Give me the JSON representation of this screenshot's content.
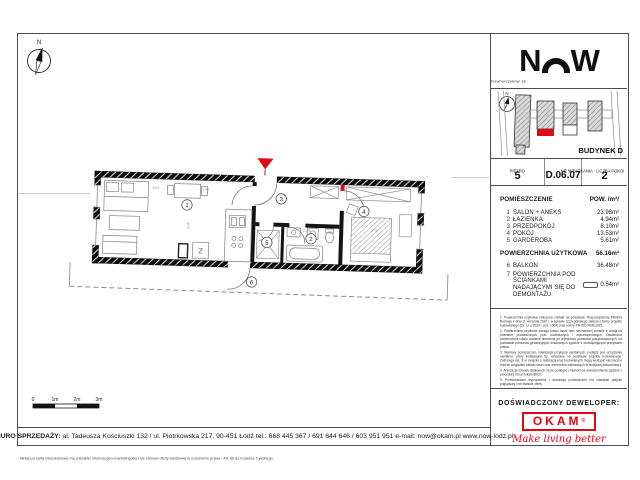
{
  "compass": {
    "label": "N"
  },
  "scalebar": {
    "labels": [
      "0",
      "1m",
      "2m",
      "3m"
    ]
  },
  "plan": {
    "kitchen_label": "Z",
    "dims": [
      "6.03",
      "5.88",
      "3.60",
      "2.38",
      "3.78"
    ],
    "room_markers": [
      "1",
      "2",
      "3",
      "4",
      "5",
      "6"
    ]
  },
  "sidebar": {
    "logo": {
      "left": "N",
      "right": "W",
      "subtitle": "Dowborczyków 18"
    },
    "sitemap": {
      "compass_label": "N",
      "building_label": "BUDYNEK D"
    },
    "unit": {
      "fields": [
        {
          "label": "PIĘTRO",
          "value": "5"
        },
        {
          "label": "NR MIESZKANIA",
          "value": "D.06.07"
        },
        {
          "label": "LICZBA POKOI",
          "value": "2"
        }
      ]
    },
    "rooms": {
      "header_name": "POMIESZCZENIE",
      "header_area": "POW. /m²/",
      "items": [
        {
          "no": "1",
          "name": "SALON + ANEKS",
          "area": "23.98m²"
        },
        {
          "no": "2",
          "name": "ŁAZIENKA",
          "area": "4.94m²"
        },
        {
          "no": "3",
          "name": "PRZEDPOKÓJ",
          "area": "8.10m²"
        },
        {
          "no": "4",
          "name": "POKÓJ",
          "area": "13.53m²"
        },
        {
          "no": "5",
          "name": "GARDEROBA",
          "area": "5.61m²"
        }
      ],
      "total_label": "POWIERZCHNIA UŻYTKOWA",
      "total_area": "56.16m²",
      "extra_items": [
        {
          "no": "6",
          "name": "BALKON",
          "area": "36.48m²"
        },
        {
          "no": "7",
          "name": "POWIERZCHNIA POD ŚCIANKAMI NADAJĄCYMI SIĘ DO DEMONTAŻU",
          "area": "0.54m²"
        }
      ]
    },
    "legal": {
      "paragraphs": [
        "1. Powierzchnia użytkowa obliczona została na podstawie Rozporządzenia Ministra Rozwoju z dnia 11 września 2020 r. w sprawie szczegółowego zakresu i formy projektu budowlanego (Dz. U. z 2020 r. poz. 1609) oraz normy PN-ISO 9836:2015.",
        "2. Powierzchnia użytkowa danego lokalu może ulec nieznacznej zmianie z uwagi na charakter prowadzonych prac budowlanych i wykończeniowych. Ostateczna powierzchnia lokalu zostanie określona po wykonaniu pomiarów powykonawczych, na podstawie pomiarów geodezyjnych dokonanych zgodnie z obowiązującymi przepisami prawa.",
        "3. Wymiary pomieszczeń, lokalizacja przyłączy sanitarnych, podejść pod urządzenia sanitarne, piony instalacyjne itp. wskazane na podstawie projektu budowlanego. Zastrzega się, iż w związku z realizacją prac budowlanych mogą wystąpić nieznaczne różnice względem układu ścian oraz elementów wskazanych w niniejszej dokumentacji.",
        "4. Aranżacja ścianek działowych może podlegać zmianom na wniosek klienta zgodnie z procedurą zmian lokatorskich.",
        "5. Przedstawione wyposażenie i aranżacja pomieszczeń ma charakter jedynie poglądowy i nie stanowi oferty."
      ]
    },
    "developer": {
      "label": "DOŚWIADCZONY DEWELOPER:",
      "logo_text": "OKAM",
      "logo_mark": "®",
      "tagline": "Make living better"
    }
  },
  "footer": {
    "sales_label": "BIURO SPRZEDAŻY:",
    "sales_text": "al. Tadeusza Kościuszki 132 / ul. Piotrkowska 217, 90-451 Łódź tel.: 668 445 367 / 691 644 646 / 603 951 951 e-mail: now@okam.pl www.now-lodz.pl",
    "disclaimer": "Niniejsza karta mieszkaniowa ma charakter informacyjno-marketingowy i nie stanowi oferty handlowej w rozumieniu prawa - Art. 66 §1 Kodeksu Cywilnego."
  },
  "colors": {
    "accent_red": "#e30613",
    "wall_black": "#0c0c0c"
  }
}
